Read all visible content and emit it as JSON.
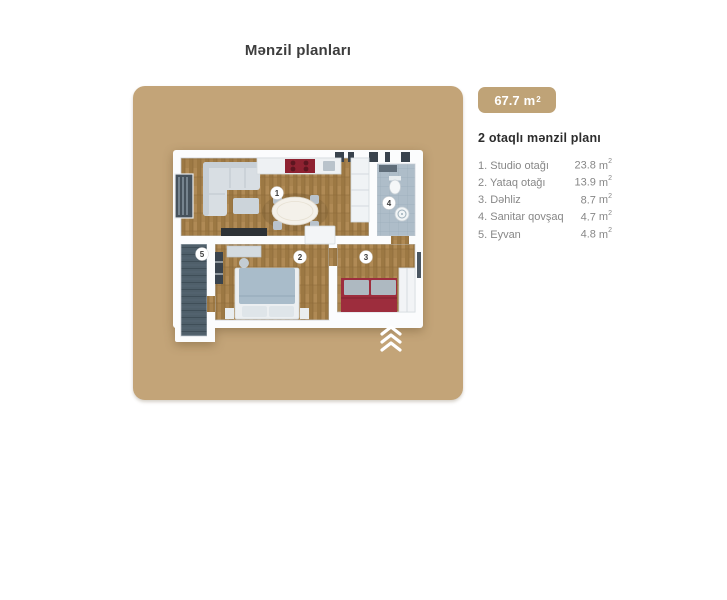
{
  "page": {
    "title": "Mənzil planları"
  },
  "badge": {
    "value": "67.7",
    "unit": "m",
    "unit_sup": "2"
  },
  "legend": {
    "heading": "2 otaqlı mənzil planı",
    "unit": "m",
    "unit_sup": "2",
    "items": [
      {
        "label": "1. Studio otağı",
        "value": "23.8"
      },
      {
        "label": "2. Yataq otağı",
        "value": "13.9"
      },
      {
        "label": "3. Dəhliz",
        "value": "8.7"
      },
      {
        "label": "4. Sanitar qovşaq",
        "value": "4.7"
      },
      {
        "label": "5. Eyvan",
        "value": "4.8"
      }
    ]
  },
  "floorplan": {
    "rooms": [
      {
        "number": "1"
      },
      {
        "number": "2"
      },
      {
        "number": "3"
      },
      {
        "number": "4"
      },
      {
        "number": "5"
      }
    ],
    "colors": {
      "card_tan": "#c3a478",
      "wall_white": "#fbfcfd",
      "wood_floor": "#a8834e",
      "bath_floor": "#aebdc9",
      "balcony_floor": "#4f5f6a",
      "accent_red": "#9d2d3d"
    }
  }
}
